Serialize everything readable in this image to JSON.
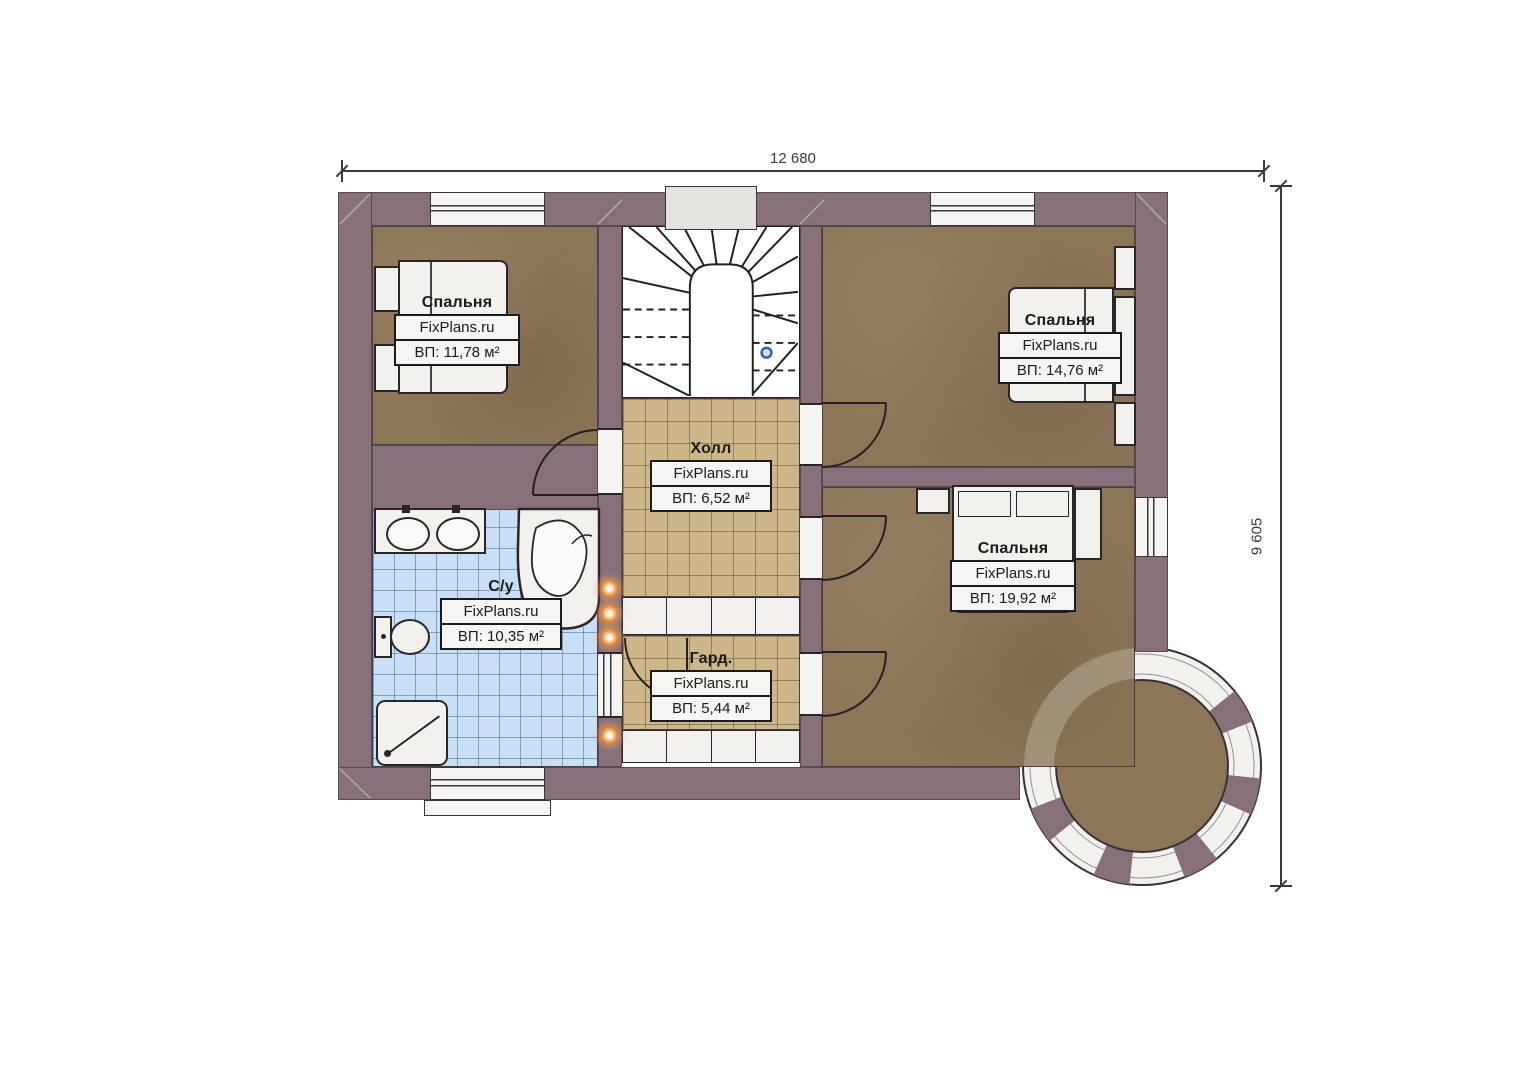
{
  "plan": {
    "dimensions": {
      "width_label": "12 680",
      "height_label": "9 605"
    },
    "rooms": {
      "bedroom_left": {
        "name": "Спальня",
        "brand": "FixPlans.ru",
        "area": "ВП: 11,78 м²"
      },
      "bedroom_top_right": {
        "name": "Спальня",
        "brand": "FixPlans.ru",
        "area": "ВП: 14,76 м²"
      },
      "bedroom_bottom_right": {
        "name": "Спальня",
        "brand": "FixPlans.ru",
        "area": "ВП: 19,92 м²"
      },
      "hall": {
        "name": "Холл",
        "brand": "FixPlans.ru",
        "area": "ВП: 6,52 м²"
      },
      "bathroom": {
        "name": "С/у",
        "brand": "FixPlans.ru",
        "area": "ВП: 10,35 м²"
      },
      "wardrobe": {
        "name": "Гард.",
        "brand": "FixPlans.ru",
        "area": "ВП: 5,44 м²"
      }
    },
    "colors": {
      "wall": "#87707a",
      "bedroom_floor": "#8d7557",
      "hall_tile": "#cdb689",
      "bath_tile": "#c8dff6",
      "fixture": "#f2f1ee",
      "accent_orange": "#e07a2c",
      "stair_marker_blue": "#2f62a8"
    }
  }
}
